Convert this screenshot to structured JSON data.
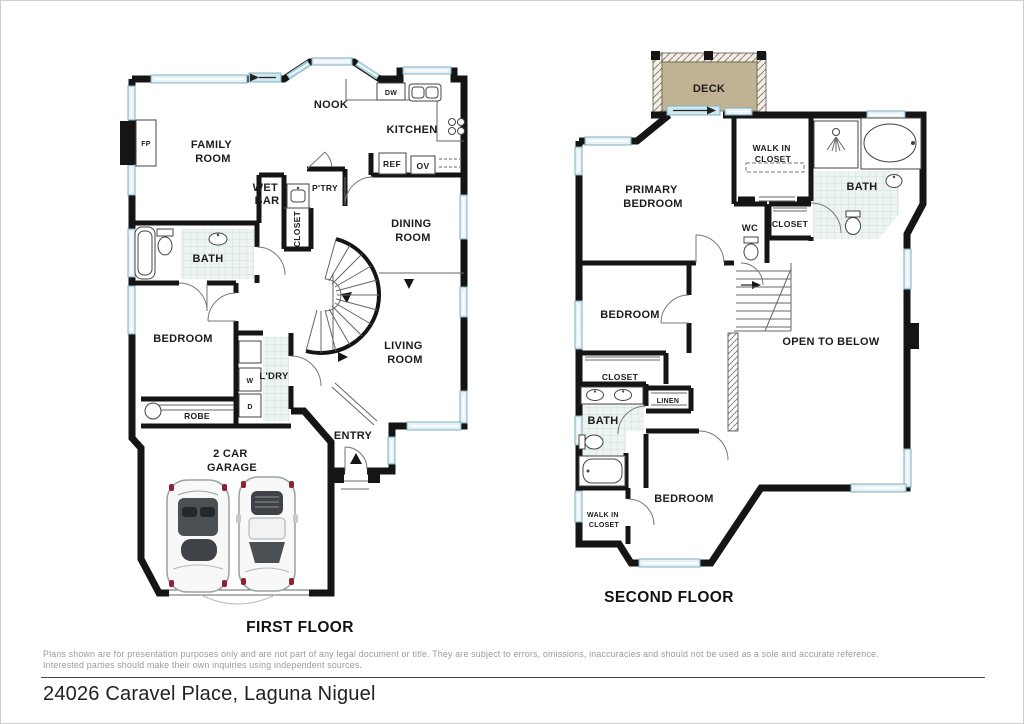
{
  "address": "24026 Caravel Place, Laguna Niguel",
  "disclaimer": {
    "line1": "Plans shown are for presentation purposes only and are not part of any legal document or title. They are subject to errors, omissions, inaccuracies and should not be used as a sole and accurate reference.",
    "line2": "Interested parties should make their own inquiries using independent sources."
  },
  "colors": {
    "wall": "#151515",
    "window_accent": "#7fb0c0",
    "window_fill": "#e4f1f6",
    "deck_fill": "#c2b294",
    "tile_fill": "#edf4f2",
    "car_accent": "#8c2332"
  },
  "floor1": {
    "title": "FIRST FLOOR",
    "rooms": {
      "family_room": [
        "FAMILY",
        "ROOM"
      ],
      "nook": "NOOK",
      "kitchen": "KITCHEN",
      "wet_bar": [
        "WET",
        "BAR"
      ],
      "pantry": "P'TRY",
      "closet": "CLOSET",
      "dining_room": [
        "DINING",
        "ROOM"
      ],
      "bath": "BATH",
      "bedroom": "BEDROOM",
      "laundry": "L'DRY",
      "robe": "ROBE",
      "living_room": [
        "LIVING",
        "ROOM"
      ],
      "entry": "ENTRY",
      "garage": [
        "2 CAR",
        "GARAGE"
      ]
    },
    "fixtures": {
      "fireplace": "FP",
      "dishwasher": "DW",
      "refrigerator": "REF",
      "oven": "OV",
      "washer": "W",
      "dryer": "D"
    }
  },
  "floor2": {
    "title": "SECOND FLOOR",
    "rooms": {
      "deck": "DECK",
      "primary_bedroom": [
        "PRIMARY",
        "BEDROOM"
      ],
      "walk_in_closet_primary": [
        "WALK IN",
        "CLOSET"
      ],
      "bath_primary": "BATH",
      "closet_primary": "CLOSET",
      "wc": "WC",
      "bedroom_mid": "BEDROOM",
      "closet_mid": "CLOSET",
      "linen": "LINEN",
      "bath_hall": "BATH",
      "open_to_below": "OPEN TO BELOW",
      "bedroom_back": "BEDROOM",
      "walk_in_closet_back": [
        "WALK IN",
        "CLOSET"
      ]
    }
  }
}
